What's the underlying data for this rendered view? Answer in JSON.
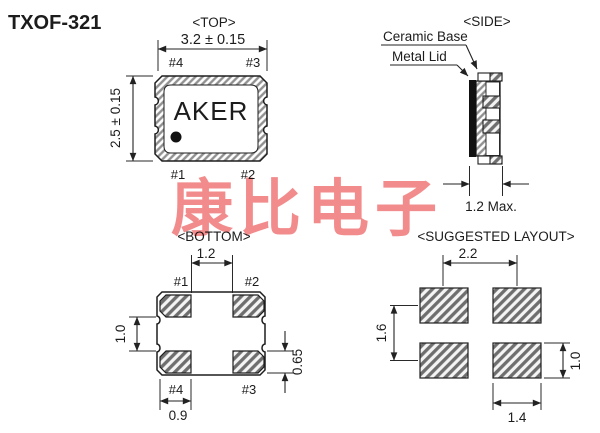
{
  "title": "TXOF-321",
  "watermark": {
    "text": "康比电子",
    "color": "#f18282"
  },
  "colors": {
    "line": "#222222",
    "hatch_gray": "#808080",
    "lid_black": "#111111",
    "background": "#ffffff"
  },
  "views": {
    "top": {
      "label": "<TOP>",
      "brand": "AKER",
      "dims": {
        "width": "3.2 ± 0.15",
        "height": "2.5 ± 0.15"
      },
      "pins": {
        "top_left": "#4",
        "top_right": "#3",
        "bottom_left": "#1",
        "bottom_right": "#2"
      }
    },
    "side": {
      "label": "<SIDE>",
      "callouts": {
        "ceramic_base": "Ceramic Base",
        "metal_lid": "Metal Lid"
      },
      "dims": {
        "thickness": "1.2 Max."
      }
    },
    "bottom": {
      "label": "<BOTTOM>",
      "dims": {
        "pad_gap_x": "1.2",
        "pad_gap_y": "1.0",
        "pad_height": "0.65",
        "pad_width": "0.9"
      },
      "pins": {
        "top_left": "#1",
        "top_right": "#2",
        "bottom_left": "#4",
        "bottom_right": "#3"
      }
    },
    "layout": {
      "label": "<SUGGESTED LAYOUT>",
      "dims": {
        "pitch_x": "2.2",
        "pitch_y": "1.6",
        "pad_height": "1.0",
        "pad_width": "1.4"
      }
    }
  }
}
